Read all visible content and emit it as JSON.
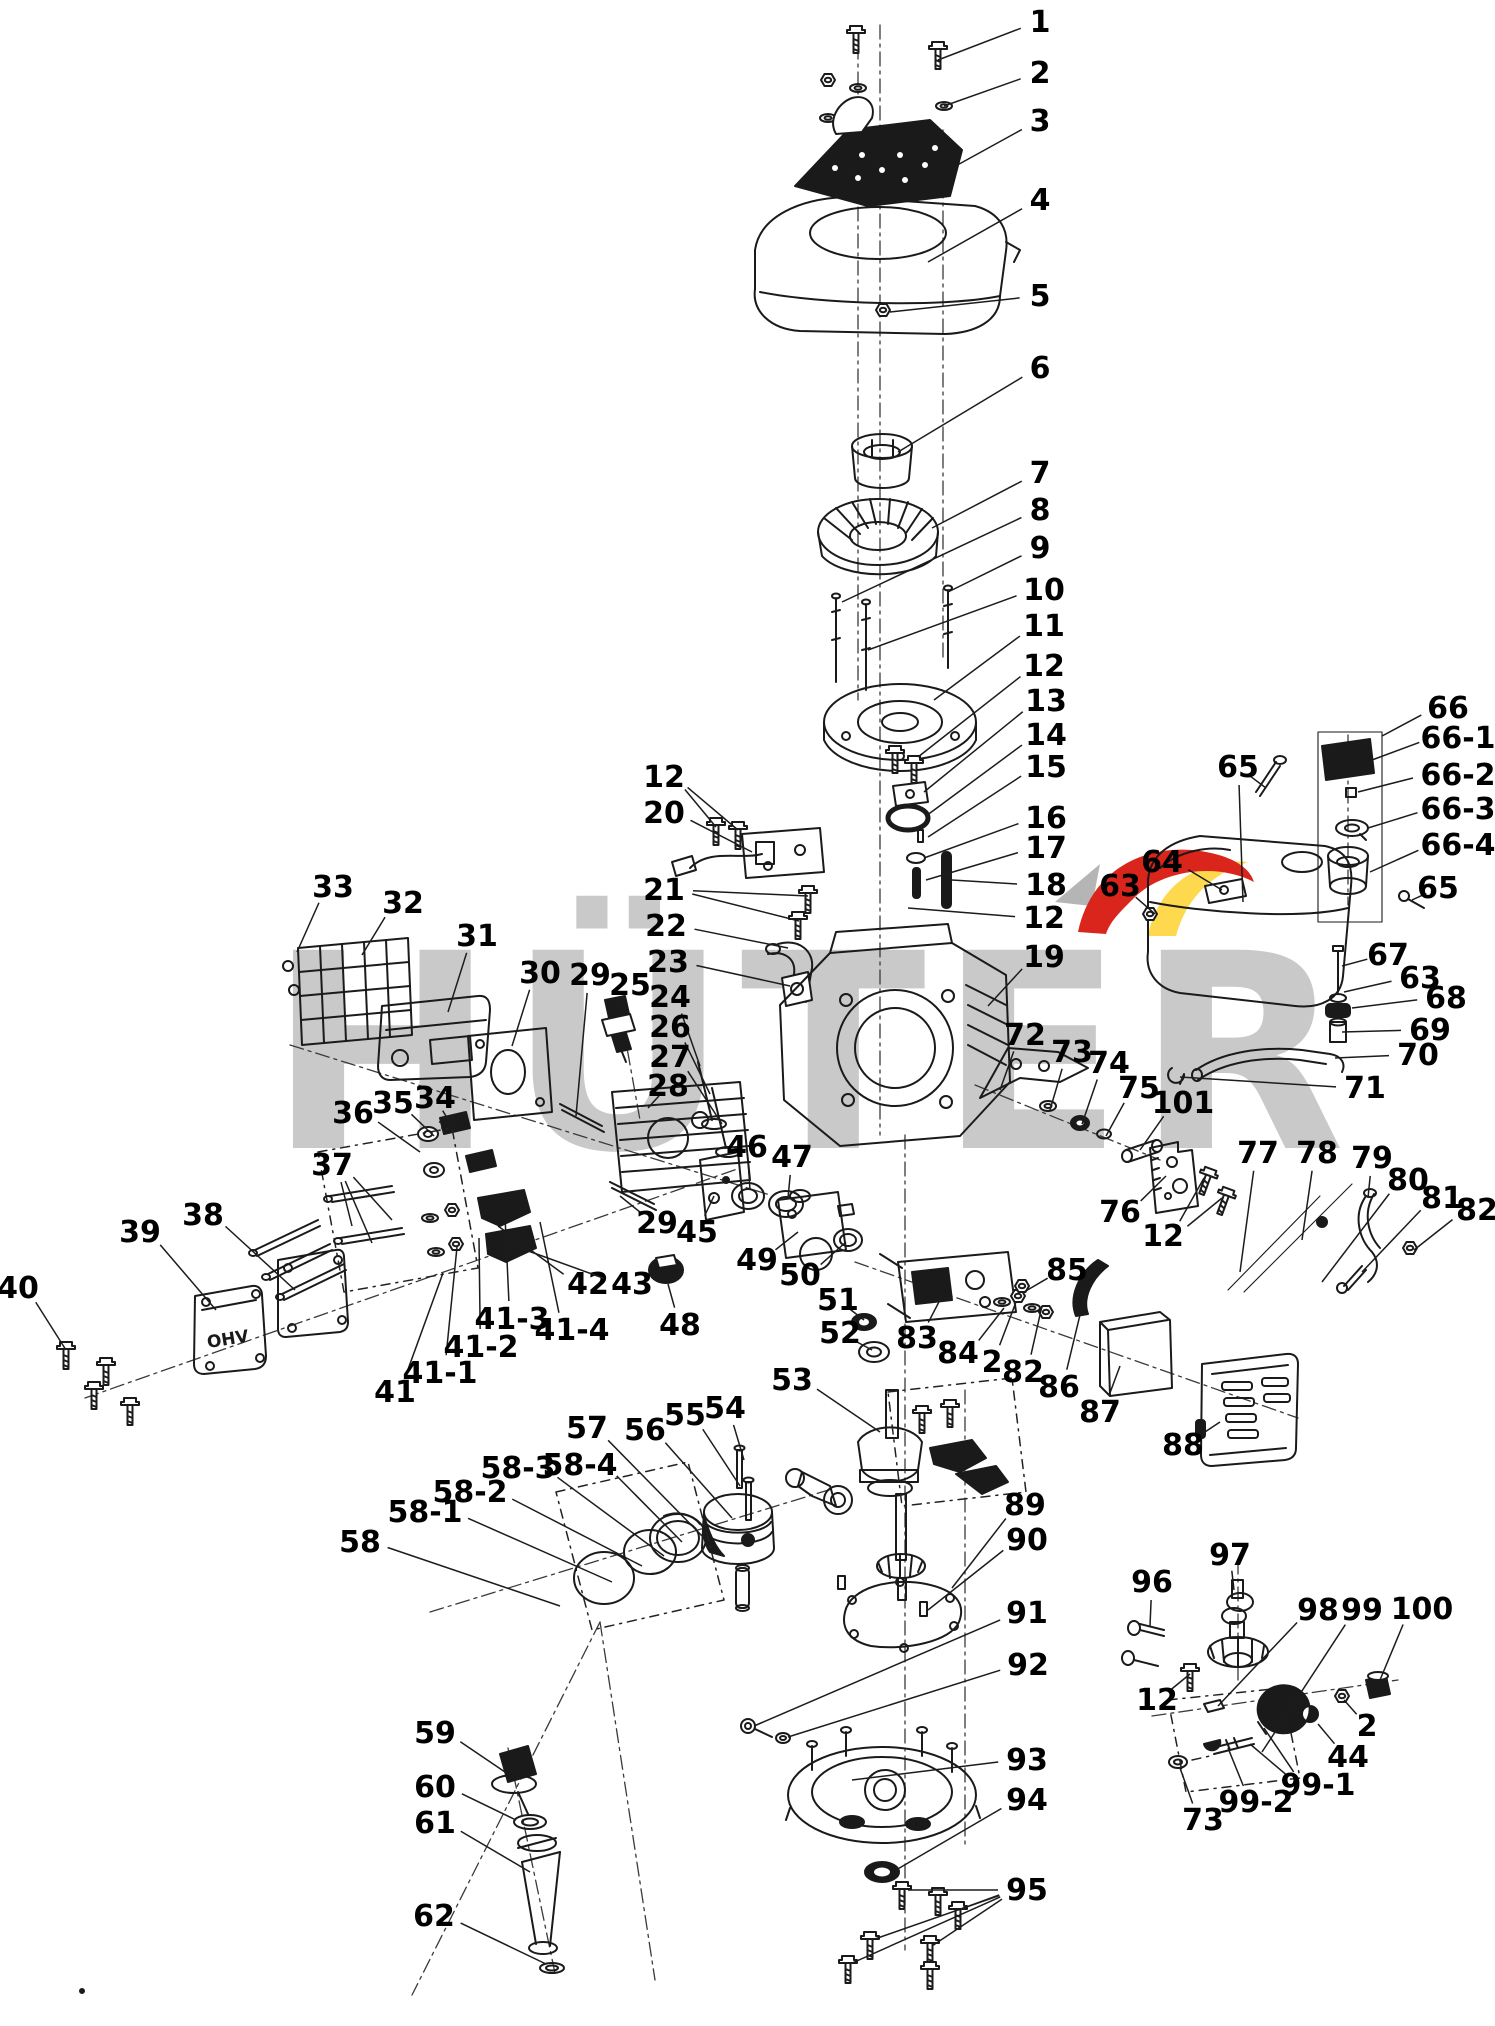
{
  "watermark": {
    "text": "HÜTER",
    "color": "#c9c9c9",
    "red": "#da251d",
    "yellow": "#ffd94d",
    "gray": "#b5b5b5"
  },
  "valve_cover_text": "OHV",
  "labels": [
    {
      "t": "1",
      "x": 1040,
      "y": 22,
      "to": [
        [
          938,
          60
        ]
      ]
    },
    {
      "t": "2",
      "x": 1040,
      "y": 73,
      "to": [
        [
          944,
          106
        ]
      ]
    },
    {
      "t": "3",
      "x": 1040,
      "y": 121,
      "to": [
        [
          952,
          168
        ]
      ]
    },
    {
      "t": "4",
      "x": 1040,
      "y": 200,
      "to": [
        [
          928,
          262
        ]
      ]
    },
    {
      "t": "5",
      "x": 1040,
      "y": 296,
      "to": [
        [
          890,
          312
        ]
      ]
    },
    {
      "t": "6",
      "x": 1040,
      "y": 368,
      "to": [
        [
          898,
          452
        ]
      ]
    },
    {
      "t": "7",
      "x": 1040,
      "y": 473,
      "to": [
        [
          932,
          528
        ]
      ]
    },
    {
      "t": "8",
      "x": 1040,
      "y": 510,
      "to": [
        [
          842,
          602
        ]
      ]
    },
    {
      "t": "9",
      "x": 1040,
      "y": 548,
      "to": [
        [
          948,
          592
        ]
      ]
    },
    {
      "t": "10",
      "x": 1044,
      "y": 590,
      "to": [
        [
          868,
          650
        ]
      ]
    },
    {
      "t": "11",
      "x": 1044,
      "y": 626,
      "to": [
        [
          934,
          700
        ]
      ]
    },
    {
      "t": "12",
      "x": 1044,
      "y": 666,
      "to": [
        [
          918,
          757
        ]
      ]
    },
    {
      "t": "13",
      "x": 1046,
      "y": 701,
      "to": [
        [
          924,
          792
        ]
      ]
    },
    {
      "t": "14",
      "x": 1046,
      "y": 735,
      "to": [
        [
          926,
          816
        ]
      ]
    },
    {
      "t": "15",
      "x": 1046,
      "y": 767,
      "to": [
        [
          928,
          837
        ]
      ]
    },
    {
      "t": "16",
      "x": 1046,
      "y": 818,
      "to": [
        [
          924,
          858
        ]
      ]
    },
    {
      "t": "17",
      "x": 1046,
      "y": 848,
      "to": [
        [
          926,
          880
        ]
      ]
    },
    {
      "t": "18",
      "x": 1046,
      "y": 885,
      "to": [
        [
          952,
          880
        ]
      ]
    },
    {
      "t": "12",
      "x": 1044,
      "y": 918,
      "to": [
        [
          908,
          908
        ]
      ]
    },
    {
      "t": "19",
      "x": 1044,
      "y": 957,
      "to": [
        [
          988,
          1006
        ]
      ]
    },
    {
      "t": "12",
      "x": 664,
      "y": 777,
      "to": [
        [
          716,
          827
        ],
        [
          738,
          830
        ]
      ]
    },
    {
      "t": "20",
      "x": 664,
      "y": 813,
      "to": [
        [
          752,
          852
        ]
      ]
    },
    {
      "t": "21",
      "x": 664,
      "y": 890,
      "to": [
        [
          808,
          896
        ],
        [
          799,
          921
        ]
      ]
    },
    {
      "t": "22",
      "x": 666,
      "y": 926,
      "to": [
        [
          788,
          948
        ]
      ]
    },
    {
      "t": "23",
      "x": 668,
      "y": 962,
      "to": [
        [
          790,
          986
        ]
      ]
    },
    {
      "t": "24",
      "x": 670,
      "y": 997,
      "to": [
        [
          700,
          1066
        ]
      ]
    },
    {
      "t": "25",
      "x": 630,
      "y": 985,
      "to": [
        [
          617,
          1008
        ]
      ]
    },
    {
      "t": "26",
      "x": 670,
      "y": 1027,
      "to": [
        [
          710,
          1094
        ]
      ]
    },
    {
      "t": "27",
      "x": 670,
      "y": 1057,
      "to": [
        [
          722,
          1124
        ]
      ]
    },
    {
      "t": "28",
      "x": 668,
      "y": 1086,
      "to": [
        [
          648,
          1108
        ]
      ]
    },
    {
      "t": "29",
      "x": 590,
      "y": 975,
      "to": [
        [
          576,
          1116
        ]
      ]
    },
    {
      "t": "30",
      "x": 540,
      "y": 973,
      "to": [
        [
          512,
          1046
        ]
      ]
    },
    {
      "t": "31",
      "x": 477,
      "y": 936,
      "to": [
        [
          448,
          1012
        ]
      ]
    },
    {
      "t": "32",
      "x": 403,
      "y": 903,
      "to": [
        [
          362,
          955
        ]
      ]
    },
    {
      "t": "33",
      "x": 333,
      "y": 887,
      "to": [
        [
          297,
          952
        ]
      ]
    },
    {
      "t": "34",
      "x": 435,
      "y": 1098,
      "to": [
        [
          452,
          1126
        ]
      ]
    },
    {
      "t": "35",
      "x": 393,
      "y": 1103,
      "to": [
        [
          434,
          1136
        ]
      ]
    },
    {
      "t": "36",
      "x": 353,
      "y": 1113,
      "to": [
        [
          420,
          1152
        ]
      ]
    },
    {
      "t": "37",
      "x": 332,
      "y": 1165,
      "to": [
        [
          352,
          1226
        ],
        [
          372,
          1243
        ],
        [
          392,
          1220
        ]
      ]
    },
    {
      "t": "38",
      "x": 203,
      "y": 1215,
      "to": [
        [
          295,
          1290
        ]
      ]
    },
    {
      "t": "39",
      "x": 140,
      "y": 1232,
      "to": [
        [
          216,
          1310
        ]
      ]
    },
    {
      "t": "40",
      "x": 18,
      "y": 1288,
      "to": [
        [
          66,
          1350
        ]
      ]
    },
    {
      "t": "41",
      "x": 395,
      "y": 1392,
      "to": [
        [
          443,
          1273
        ]
      ]
    },
    {
      "t": "41-1",
      "x": 440,
      "y": 1373,
      "to": [
        [
          457,
          1247
        ]
      ]
    },
    {
      "t": "41-2",
      "x": 481,
      "y": 1347,
      "to": [
        [
          479,
          1238
        ]
      ]
    },
    {
      "t": "41-3",
      "x": 512,
      "y": 1319,
      "to": [
        [
          505,
          1216
        ]
      ]
    },
    {
      "t": "41-4",
      "x": 572,
      "y": 1330,
      "to": [
        [
          540,
          1222
        ]
      ]
    },
    {
      "t": "42",
      "x": 588,
      "y": 1284,
      "to": [
        [
          498,
          1226
        ]
      ]
    },
    {
      "t": "43",
      "x": 632,
      "y": 1284,
      "to": [
        [
          520,
          1248
        ]
      ]
    },
    {
      "t": "29",
      "x": 657,
      "y": 1223,
      "to": [
        [
          620,
          1196
        ]
      ]
    },
    {
      "t": "45",
      "x": 697,
      "y": 1232,
      "to": [
        [
          714,
          1196
        ]
      ]
    },
    {
      "t": "46",
      "x": 747,
      "y": 1147,
      "to": [
        [
          750,
          1190
        ]
      ]
    },
    {
      "t": "47",
      "x": 792,
      "y": 1157,
      "to": [
        [
          788,
          1198
        ]
      ]
    },
    {
      "t": "48",
      "x": 680,
      "y": 1325,
      "to": [
        [
          668,
          1284
        ]
      ]
    },
    {
      "t": "49",
      "x": 757,
      "y": 1260,
      "to": [
        [
          798,
          1232
        ]
      ]
    },
    {
      "t": "50",
      "x": 800,
      "y": 1275,
      "to": [
        [
          846,
          1242
        ]
      ]
    },
    {
      "t": "51",
      "x": 838,
      "y": 1300,
      "to": [
        [
          864,
          1320
        ]
      ]
    },
    {
      "t": "52",
      "x": 840,
      "y": 1333,
      "to": [
        [
          872,
          1350
        ]
      ]
    },
    {
      "t": "53",
      "x": 792,
      "y": 1380,
      "to": [
        [
          880,
          1432
        ]
      ]
    },
    {
      "t": "54",
      "x": 725,
      "y": 1408,
      "to": [
        [
          744,
          1460
        ]
      ]
    },
    {
      "t": "55",
      "x": 685,
      "y": 1415,
      "to": [
        [
          740,
          1486
        ]
      ]
    },
    {
      "t": "56",
      "x": 645,
      "y": 1430,
      "to": [
        [
          732,
          1518
        ]
      ]
    },
    {
      "t": "57",
      "x": 587,
      "y": 1428,
      "to": [
        [
          706,
          1540
        ]
      ]
    },
    {
      "t": "58-4",
      "x": 580,
      "y": 1465,
      "to": [
        [
          682,
          1542
        ]
      ]
    },
    {
      "t": "58-3",
      "x": 518,
      "y": 1468,
      "to": [
        [
          664,
          1556
        ]
      ]
    },
    {
      "t": "58-2",
      "x": 470,
      "y": 1492,
      "to": [
        [
          642,
          1566
        ]
      ]
    },
    {
      "t": "58-1",
      "x": 425,
      "y": 1512,
      "to": [
        [
          612,
          1582
        ]
      ]
    },
    {
      "t": "58",
      "x": 360,
      "y": 1542,
      "to": [
        [
          560,
          1606
        ]
      ]
    },
    {
      "t": "59",
      "x": 435,
      "y": 1733,
      "to": [
        [
          505,
          1772
        ]
      ]
    },
    {
      "t": "60",
      "x": 435,
      "y": 1787,
      "to": [
        [
          516,
          1820
        ]
      ]
    },
    {
      "t": "61",
      "x": 435,
      "y": 1823,
      "to": [
        [
          530,
          1872
        ]
      ]
    },
    {
      "t": "62",
      "x": 434,
      "y": 1916,
      "to": [
        [
          546,
          1964
        ]
      ]
    },
    {
      "t": "89",
      "x": 1025,
      "y": 1505,
      "to": [
        [
          952,
          1588
        ]
      ]
    },
    {
      "t": "90",
      "x": 1027,
      "y": 1540,
      "to": [
        [
          928,
          1610
        ]
      ]
    },
    {
      "t": "91",
      "x": 1027,
      "y": 1613,
      "to": [
        [
          754,
          1726
        ]
      ]
    },
    {
      "t": "92",
      "x": 1028,
      "y": 1665,
      "to": [
        [
          788,
          1737
        ]
      ]
    },
    {
      "t": "93",
      "x": 1027,
      "y": 1760,
      "to": [
        [
          852,
          1780
        ]
      ]
    },
    {
      "t": "94",
      "x": 1027,
      "y": 1800,
      "to": [
        [
          896,
          1870
        ]
      ]
    },
    {
      "t": "95",
      "x": 1027,
      "y": 1890,
      "to": [
        [
          908,
          1890
        ],
        [
          958,
          1910
        ],
        [
          872,
          1940
        ],
        [
          932,
          1946
        ],
        [
          850,
          1964
        ]
      ]
    },
    {
      "t": "96",
      "x": 1152,
      "y": 1582,
      "to": [
        [
          1150,
          1626
        ]
      ]
    },
    {
      "t": "97",
      "x": 1230,
      "y": 1555,
      "to": [
        [
          1234,
          1590
        ]
      ]
    },
    {
      "t": "98",
      "x": 1318,
      "y": 1610,
      "to": [
        [
          1218,
          1706
        ]
      ]
    },
    {
      "t": "99",
      "x": 1362,
      "y": 1610,
      "to": [
        [
          1262,
          1752
        ]
      ]
    },
    {
      "t": "100",
      "x": 1422,
      "y": 1609,
      "to": [
        [
          1380,
          1680
        ]
      ]
    },
    {
      "t": "12",
      "x": 1157,
      "y": 1700,
      "to": [
        [
          1190,
          1674
        ]
      ]
    },
    {
      "t": "2",
      "x": 1367,
      "y": 1726,
      "to": [
        [
          1344,
          1700
        ]
      ]
    },
    {
      "t": "44",
      "x": 1348,
      "y": 1757,
      "to": [
        [
          1318,
          1724
        ]
      ]
    },
    {
      "t": "99-1",
      "x": 1318,
      "y": 1785,
      "to": [
        [
          1264,
          1728
        ],
        [
          1250,
          1744
        ]
      ]
    },
    {
      "t": "99-2",
      "x": 1256,
      "y": 1802,
      "to": [
        [
          1228,
          1748
        ]
      ]
    },
    {
      "t": "73",
      "x": 1203,
      "y": 1820,
      "to": [
        [
          1180,
          1768
        ]
      ]
    },
    {
      "t": "72",
      "x": 1025,
      "y": 1035,
      "to": [
        [
          1000,
          1090
        ]
      ]
    },
    {
      "t": "73",
      "x": 1072,
      "y": 1052,
      "to": [
        [
          1050,
          1110
        ]
      ]
    },
    {
      "t": "74",
      "x": 1109,
      "y": 1063,
      "to": [
        [
          1082,
          1124
        ]
      ]
    },
    {
      "t": "75",
      "x": 1139,
      "y": 1088,
      "to": [
        [
          1106,
          1136
        ]
      ]
    },
    {
      "t": "101",
      "x": 1183,
      "y": 1103,
      "to": [
        [
          1140,
          1150
        ]
      ]
    },
    {
      "t": "71",
      "x": 1365,
      "y": 1088,
      "to": [
        [
          1180,
          1077
        ]
      ]
    },
    {
      "t": "76",
      "x": 1120,
      "y": 1212,
      "to": [
        [
          1166,
          1176
        ]
      ]
    },
    {
      "t": "12",
      "x": 1163,
      "y": 1236,
      "to": [
        [
          1204,
          1178
        ],
        [
          1222,
          1198
        ]
      ]
    },
    {
      "t": "77",
      "x": 1258,
      "y": 1153,
      "to": [
        [
          1240,
          1272
        ]
      ]
    },
    {
      "t": "78",
      "x": 1317,
      "y": 1153,
      "to": [
        [
          1302,
          1240
        ]
      ]
    },
    {
      "t": "79",
      "x": 1372,
      "y": 1158,
      "to": [
        [
          1368,
          1198
        ]
      ]
    },
    {
      "t": "80",
      "x": 1408,
      "y": 1180,
      "to": [
        [
          1322,
          1282
        ]
      ]
    },
    {
      "t": "81",
      "x": 1442,
      "y": 1198,
      "to": [
        [
          1362,
          1272
        ]
      ]
    },
    {
      "t": "82",
      "x": 1477,
      "y": 1210,
      "to": [
        [
          1414,
          1250
        ]
      ]
    },
    {
      "t": "83",
      "x": 917,
      "y": 1338,
      "to": [
        [
          942,
          1296
        ]
      ]
    },
    {
      "t": "84",
      "x": 958,
      "y": 1353,
      "to": [
        [
          1004,
          1308
        ]
      ]
    },
    {
      "t": "2",
      "x": 992,
      "y": 1362,
      "to": [
        [
          1016,
          1302
        ]
      ]
    },
    {
      "t": "82",
      "x": 1023,
      "y": 1372,
      "to": [
        [
          1042,
          1306
        ]
      ]
    },
    {
      "t": "85",
      "x": 1067,
      "y": 1270,
      "to": [
        [
          1024,
          1292
        ]
      ]
    },
    {
      "t": "86",
      "x": 1059,
      "y": 1387,
      "to": [
        [
          1086,
          1290
        ]
      ]
    },
    {
      "t": "87",
      "x": 1100,
      "y": 1412,
      "to": [
        [
          1120,
          1366
        ]
      ]
    },
    {
      "t": "88",
      "x": 1183,
      "y": 1445,
      "to": [
        [
          1220,
          1422
        ]
      ]
    },
    {
      "t": "65",
      "x": 1238,
      "y": 767,
      "to": [
        [
          1266,
          788
        ],
        [
          1243,
          902
        ]
      ]
    },
    {
      "t": "66",
      "x": 1448,
      "y": 708,
      "to": [
        [
          1382,
          736
        ]
      ]
    },
    {
      "t": "66-1",
      "x": 1458,
      "y": 738,
      "to": [
        [
          1372,
          760
        ]
      ]
    },
    {
      "t": "66-2",
      "x": 1458,
      "y": 775,
      "to": [
        [
          1358,
          792
        ]
      ]
    },
    {
      "t": "66-3",
      "x": 1458,
      "y": 809,
      "to": [
        [
          1368,
          828
        ]
      ]
    },
    {
      "t": "66-4",
      "x": 1458,
      "y": 845,
      "to": [
        [
          1370,
          872
        ]
      ]
    },
    {
      "t": "65",
      "x": 1438,
      "y": 888,
      "to": [
        [
          1412,
          900
        ]
      ]
    },
    {
      "t": "67",
      "x": 1388,
      "y": 955,
      "to": [
        [
          1342,
          966
        ]
      ]
    },
    {
      "t": "63",
      "x": 1420,
      "y": 978,
      "to": [
        [
          1344,
          992
        ]
      ]
    },
    {
      "t": "68",
      "x": 1446,
      "y": 998,
      "to": [
        [
          1352,
          1008
        ]
      ]
    },
    {
      "t": "69",
      "x": 1430,
      "y": 1030,
      "to": [
        [
          1342,
          1032
        ]
      ]
    },
    {
      "t": "70",
      "x": 1418,
      "y": 1055,
      "to": [
        [
          1335,
          1058
        ]
      ]
    },
    {
      "t": "64",
      "x": 1162,
      "y": 862,
      "to": [
        [
          1222,
          890
        ]
      ]
    },
    {
      "t": "63",
      "x": 1120,
      "y": 886,
      "to": [
        [
          1155,
          914
        ]
      ]
    }
  ]
}
